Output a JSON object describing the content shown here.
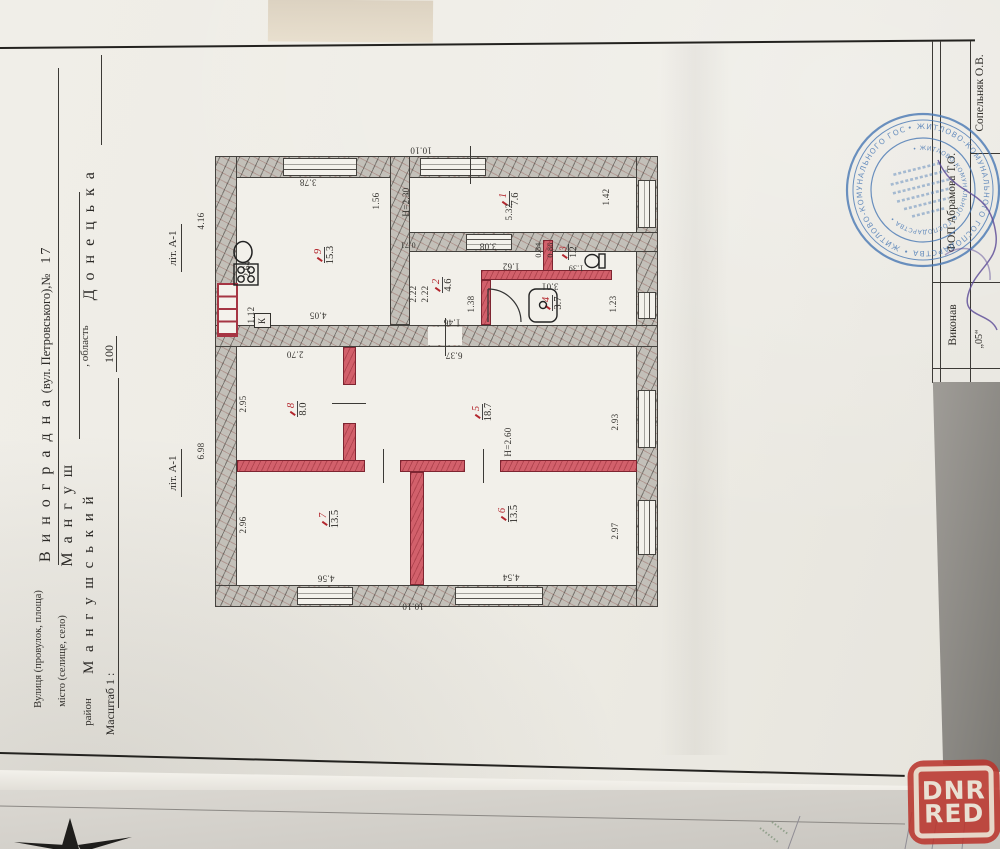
{
  "form": {
    "line1_label": "Вулиця (провулок, площа)",
    "line1_value": "В и н о г р а д н а",
    "line1_suffix": "(вул. Петровського),№",
    "line1_number": "17",
    "line2_label": "місто (селище, село)",
    "line2_value": "М а н г у ш",
    "line3_label": "район",
    "line3_value": "М а н г у ш с ь к и й",
    "line3_label2": ", область",
    "line3_value2": "Д о н е ц ь к а",
    "scale_label": "Масштаб 1 :",
    "scale_value": "100"
  },
  "plan": {
    "lit_label": "літ. А-1",
    "rooms": [
      {
        "no": "9",
        "area": "15.3"
      },
      {
        "no": "1",
        "area": "7.6"
      },
      {
        "no": "2",
        "area": "4.6"
      },
      {
        "no": "3",
        "area": "1.2"
      },
      {
        "no": "4",
        "area": "3.7"
      },
      {
        "no": "5",
        "area": "18.7"
      },
      {
        "no": "8",
        "area": "8.0"
      },
      {
        "no": "7",
        "area": "13.5"
      },
      {
        "no": "6",
        "area": "13.5"
      }
    ],
    "dims": {
      "d416": "4.16",
      "d698": "6.98",
      "d264": "2.64",
      "d112": "1.12",
      "d156": "1.56",
      "h230": "Н=2.30",
      "d222a": "2.22",
      "d222b": "2.22",
      "d138": "1.38",
      "d532": "5.32",
      "d084": "0.84",
      "d086": "0.86",
      "d123": "1.23",
      "d142": "1.42",
      "d295": "2.95",
      "d293": "2.93",
      "h260": "Н=2.60",
      "d296": "2.96",
      "d297": "2.97",
      "d378": "3.78",
      "d1010t": "10.10",
      "d071": "0.71",
      "d146": "1.46",
      "d162": "1.62",
      "d308": "3.08",
      "d139": "1.39",
      "d301": "3.01",
      "d270": "2.70",
      "d637": "6.37",
      "d405": "4.05",
      "d456": "4.56",
      "d454": "4.54",
      "d1010b": "10.10",
      "k": "К"
    }
  },
  "titleblock": {
    "executor_label": "Виконав",
    "company": "ФОП Абрамова Т.О.",
    "executor_name": "Сопельняк О.В.",
    "date": "„05“"
  },
  "stamp": {
    "ring_text": "• ЖИТЛОВО-КОМУНАЛЬНОГО ГОСПОДАРСТВА • ЖИТЛОВО-КОМУНАЛЬНОГО ГОСПОДАРСТВА",
    "inner_text": "• ЖИТЛОВО-КОМУНАЛЬНОГО ГОСПОДАРСТВА •"
  },
  "watermark": {
    "line1": "DNR",
    "line2": "RED"
  }
}
